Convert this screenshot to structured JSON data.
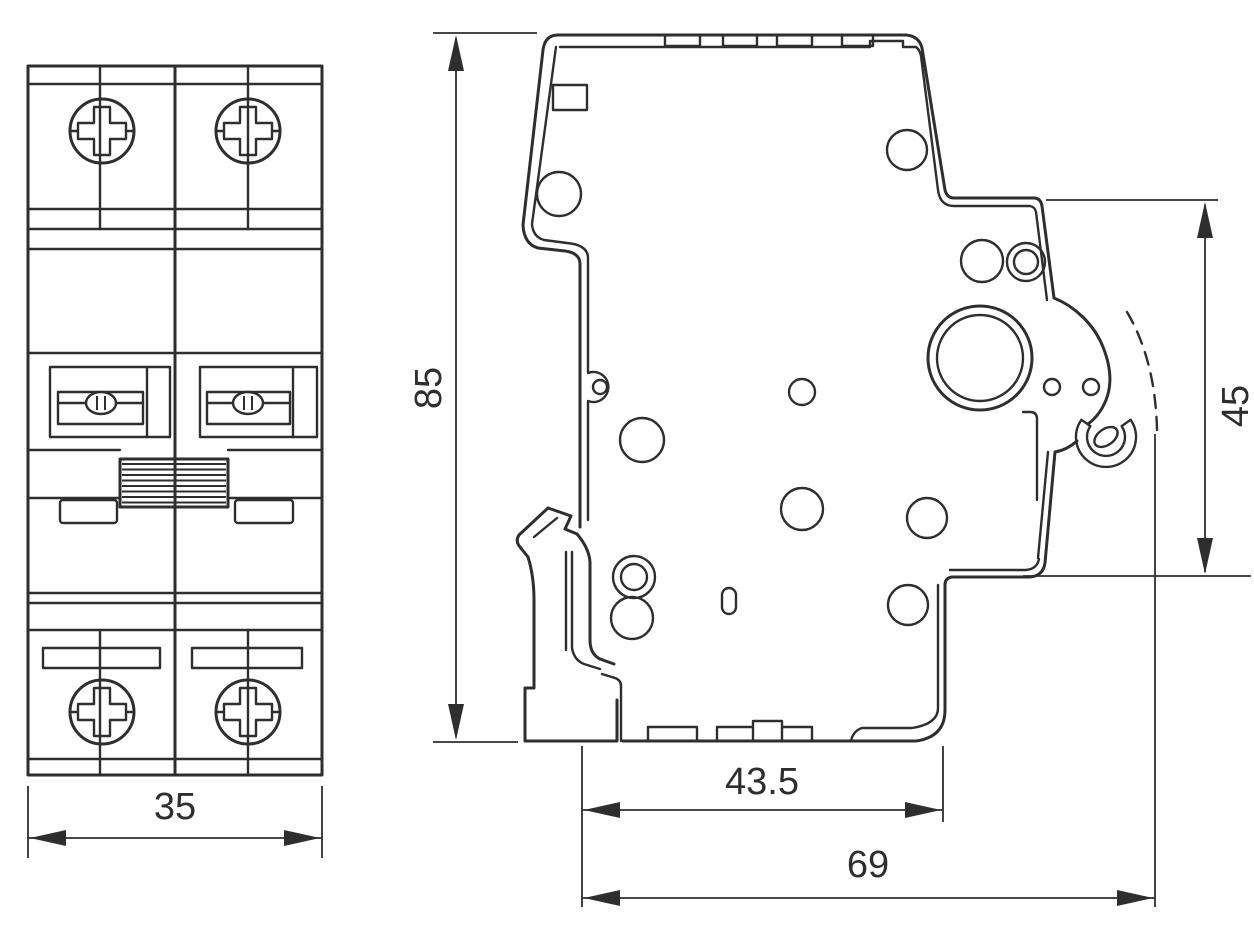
{
  "colors": {
    "background": "#ffffff",
    "line": "#2e2e2e"
  },
  "dimensions": {
    "width": "35",
    "height": "85",
    "latch_height": "45",
    "body_depth": "43.5",
    "total_depth": "69"
  }
}
